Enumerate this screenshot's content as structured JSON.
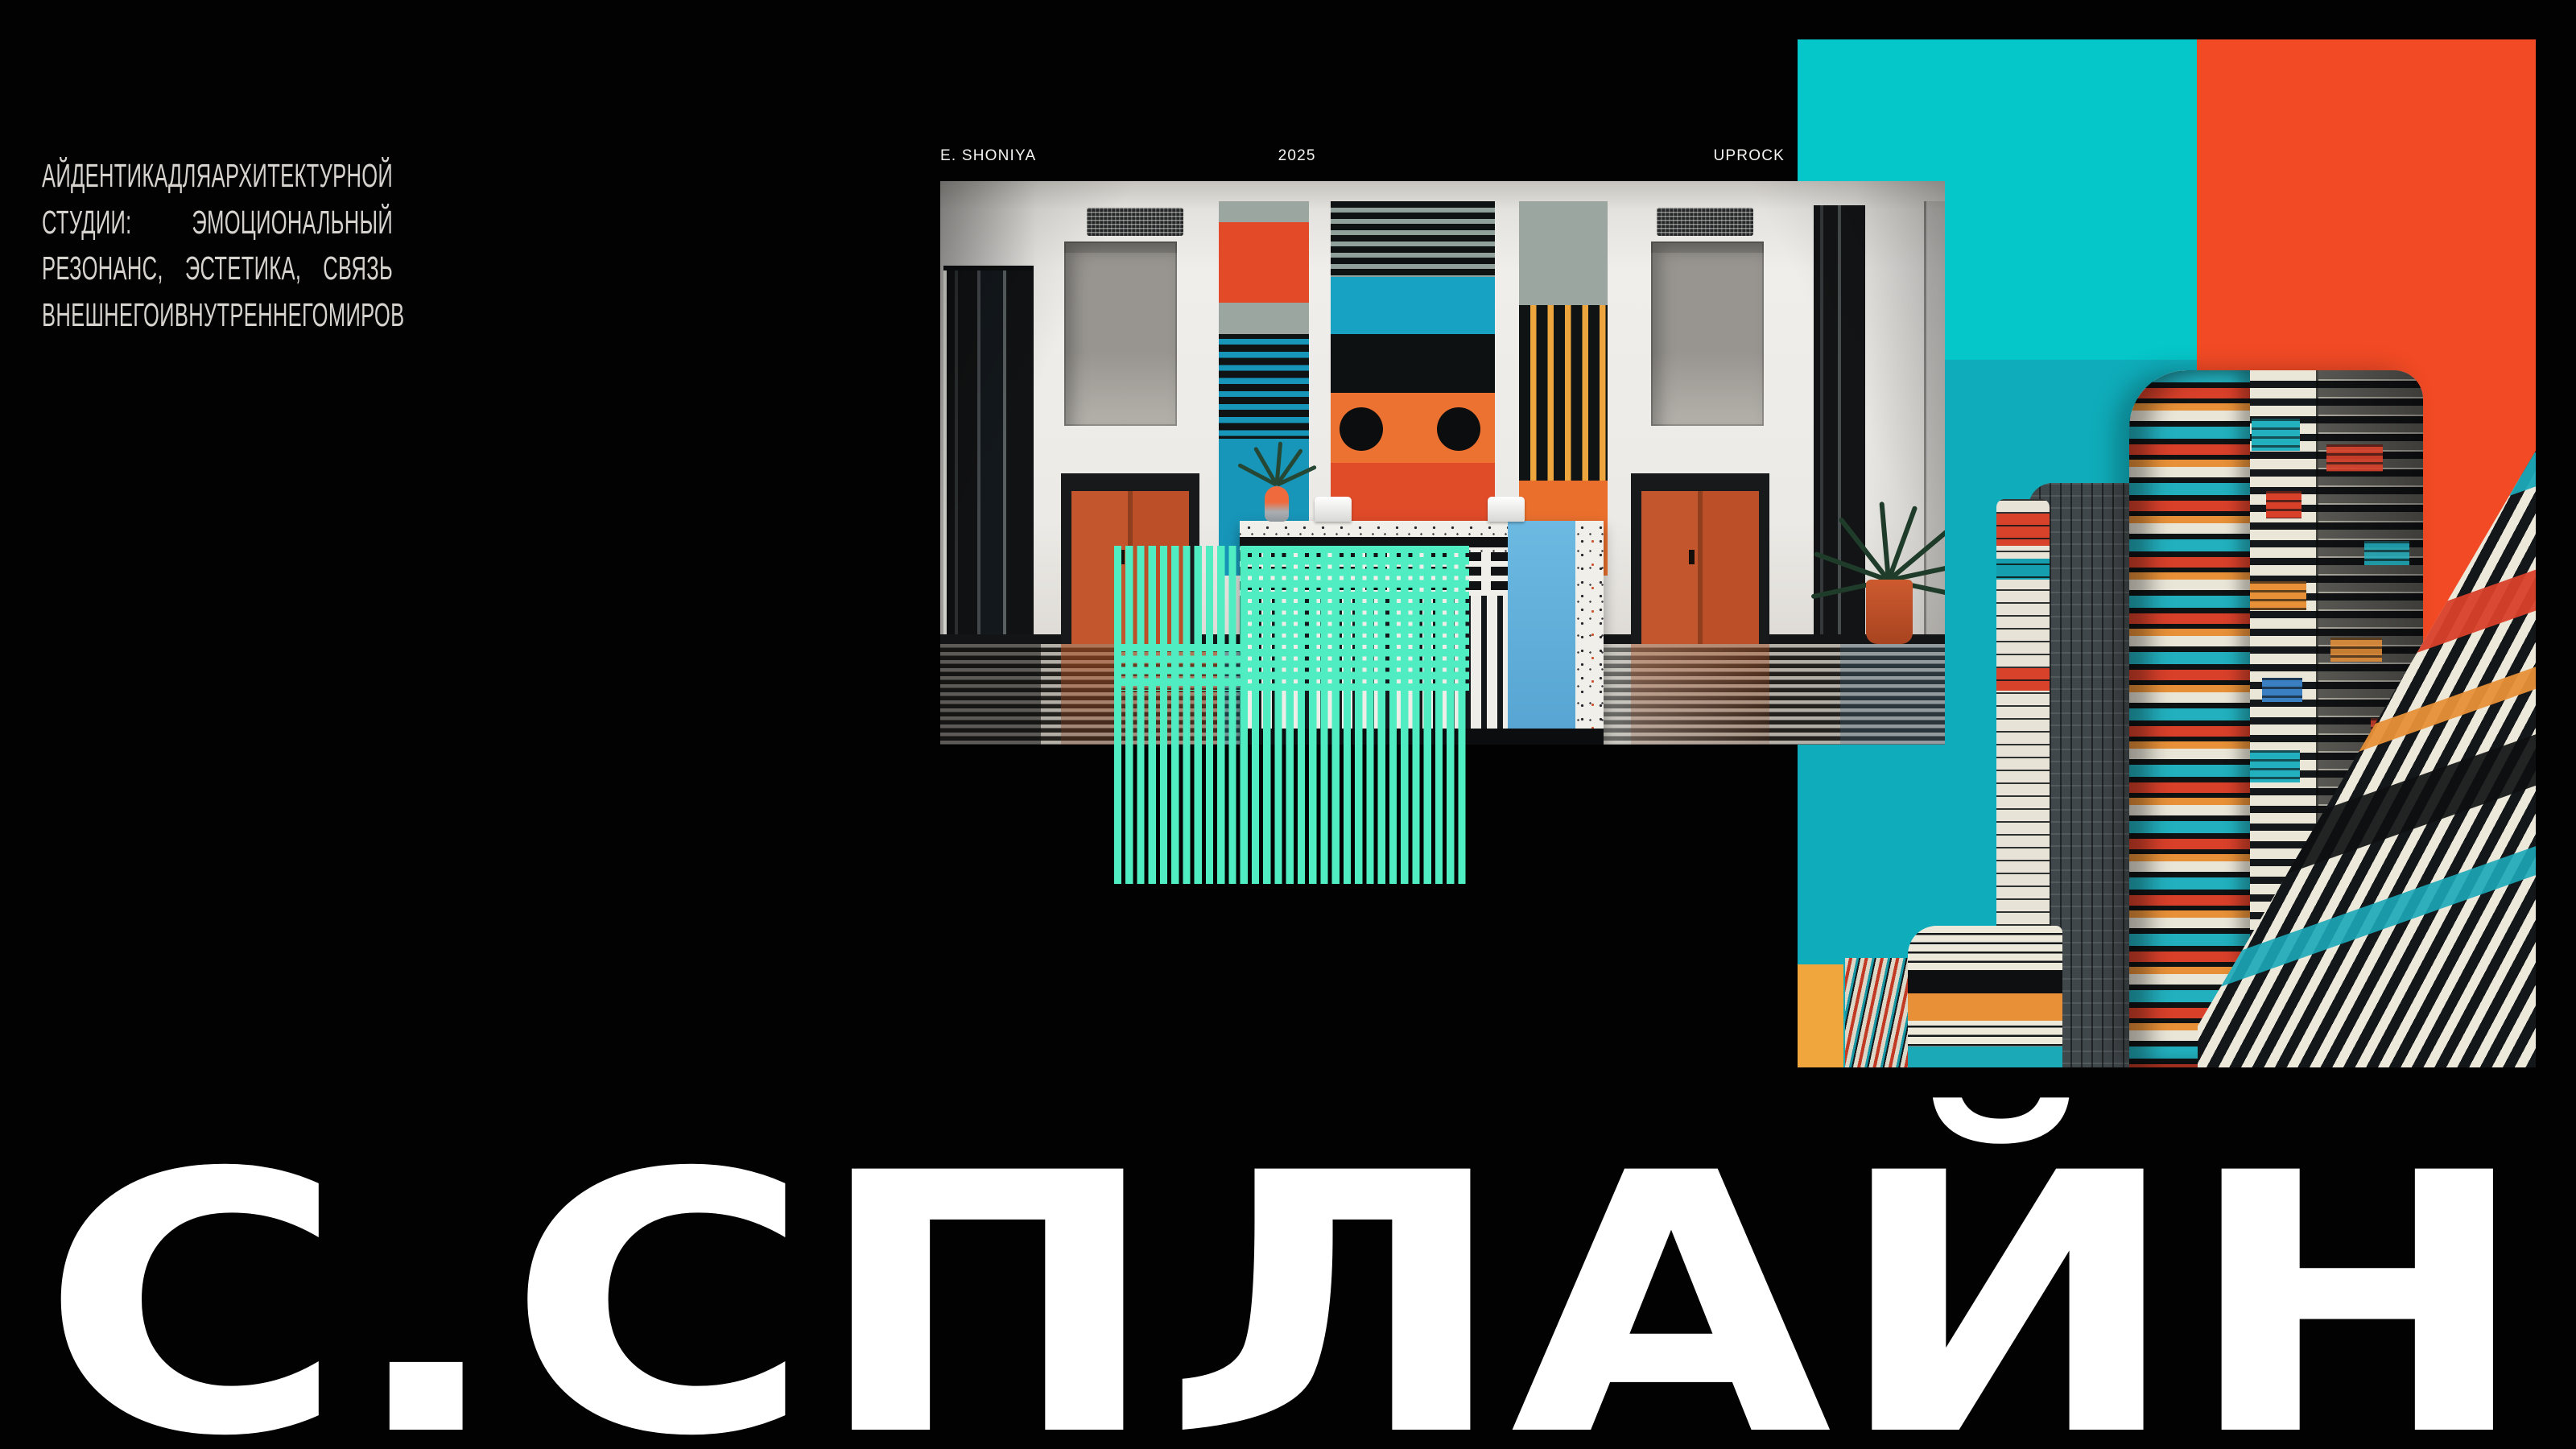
{
  "intro": {
    "lines": [
      [
        "АЙДЕНТИКА",
        "ДЛЯ",
        "АРХИТЕКТУРНОЙ"
      ],
      [
        "СТУДИИ:",
        "ЭМОЦИОНАЛЬНЫЙ"
      ],
      [
        "РЕЗОНАНС,",
        "ЭСТЕТИКА,",
        "СВЯЗЬ"
      ],
      [
        "ВНЕШНЕГО",
        "И",
        "ВНУТРЕННЕГО",
        "МИРОВ"
      ]
    ]
  },
  "credits": {
    "author": "E. SHONIYA",
    "year": "2025",
    "studio": "UPROCK"
  },
  "title": {
    "text": "С.СПЛАЙН"
  },
  "colors": {
    "background": "#020202",
    "teal_bright": "#05C6C9",
    "teal_deep": "#0FADBB",
    "orange_block": "#F14A25",
    "yellow_block": "#F1A53D",
    "mint_grid": "#4FEDC1",
    "door_orange": "#C2522B",
    "art_teal": "#1796BA",
    "art_orange": "#EC7231",
    "art_red": "#E04B28",
    "art_yellow": "#EDA63E",
    "desk_blue": "#66B6E0",
    "cream": "#EAE6D8",
    "ink": "#101314",
    "text_grey": "#D6D3CF",
    "title_white": "#FFFFFF"
  }
}
